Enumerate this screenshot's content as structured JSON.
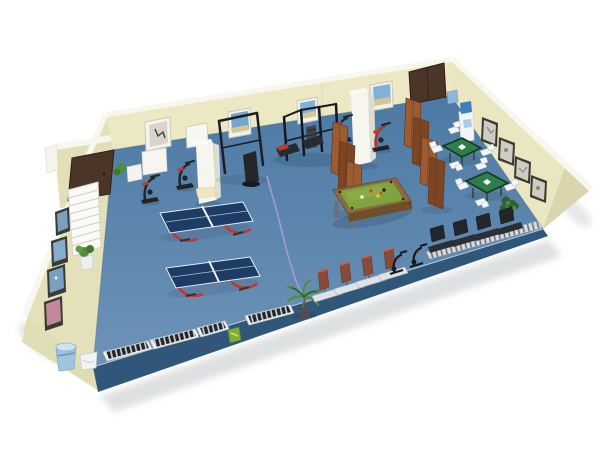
{
  "scene": {
    "title": "3D isometric cutaway render of a recreation room: ping-pong tables, billiard table, mahjong corner and gym cardio equipment",
    "view": "isometric cutaway perspective",
    "background": "white"
  },
  "colors": {
    "background": "#ffffff",
    "wall": "#ece8c3",
    "wall_left": "#e4e0b9",
    "wall_right": "#eae6bf",
    "wall_rim": "#f8f7ef",
    "floor_top": "#4c7aa4",
    "floor_bottom": "#6e93b7",
    "floor_slab": "#30567a",
    "floor_edge": "#b8cede",
    "door_wood": "#4a3526",
    "screen_wood_light": "#9a5c30",
    "screen_wood_dark": "#7c4523",
    "pool_wood": "#8a6a3e",
    "pool_felt": "#7fa33f",
    "pingpong_blue": "#1e3d66",
    "pingpong_red": "#c8352a",
    "mahjong_green": "#2e7d4a",
    "equipment_dark": "#23262b",
    "bench_seat": "#8a4a38",
    "accent_red": "#c03a2e",
    "plant_green": "#4e8f3c",
    "plant_dark": "#2f6230",
    "cable_purple": "#a89bd8",
    "water_blue": "#3e7ec0",
    "trash_blue": "#9ec4e0",
    "chair_white": "#f4f6f8",
    "picture_blue": "#6fa8cc",
    "frame_dark": "#3a3a36"
  },
  "inventory": [
    {
      "item": "ping-pong-table",
      "count": 2
    },
    {
      "item": "billiard-table",
      "count": 1
    },
    {
      "item": "mahjong-table",
      "count": 2
    },
    {
      "item": "mahjong-chair",
      "count": 8
    },
    {
      "item": "front-row-treadmill-belt",
      "count": 4
    },
    {
      "item": "black-treadmill",
      "count": 4
    },
    {
      "item": "exercise-bike",
      "count": 4
    },
    {
      "item": "spin-bike",
      "count": 2
    },
    {
      "item": "rowing-bench",
      "count": 4
    },
    {
      "item": "multi-gym-machine",
      "count": 1
    },
    {
      "item": "pull-up-rack",
      "count": 1
    },
    {
      "item": "folding-wood-screen",
      "count": 2
    },
    {
      "item": "wall-picture",
      "count": 12
    },
    {
      "item": "wood-door",
      "count": 2
    },
    {
      "item": "wall-pillar",
      "count": 2
    },
    {
      "item": "water-cooler",
      "count": 1
    },
    {
      "item": "radiator-shelf",
      "count": 1
    },
    {
      "item": "potted-plant",
      "count": 4
    },
    {
      "item": "trash-can",
      "count": 1
    },
    {
      "item": "floor-cable",
      "count": 1
    }
  ]
}
